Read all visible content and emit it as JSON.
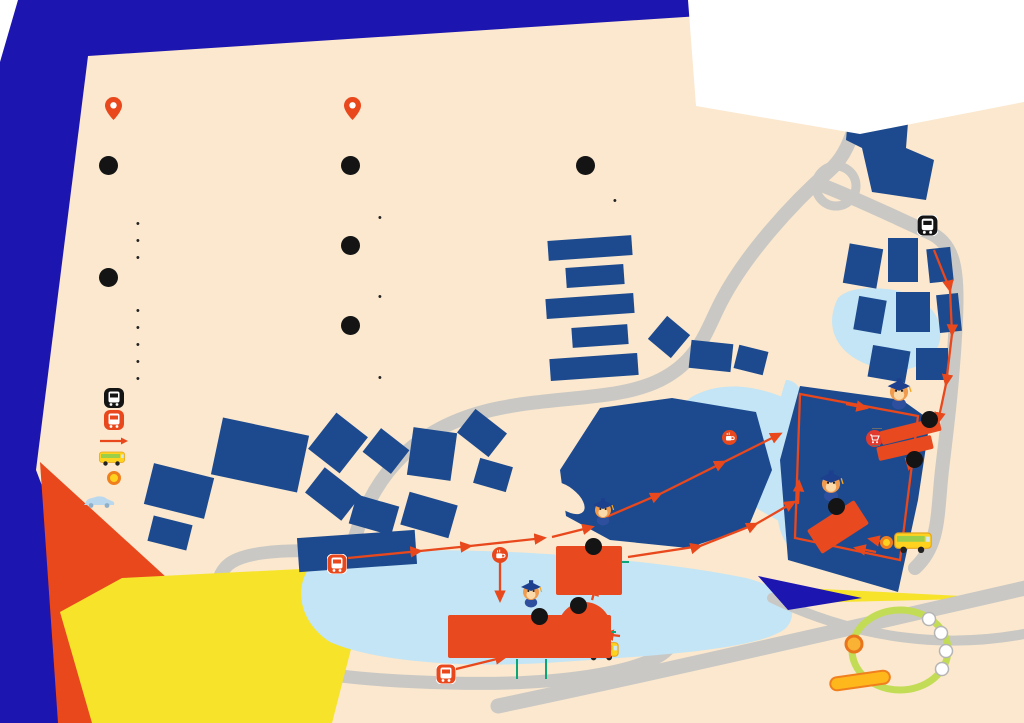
{
  "colors": {
    "bg_blue": "#1c15b0",
    "cream": "#fbe8ce",
    "red": "#e8481c",
    "navy_building": "#1d4a8e",
    "heading_indigo": "#3e3a9c",
    "label_blue": "#2b57a8",
    "teal": "#0aa678",
    "code_orange": "#f5a054",
    "yellow": "#f6e32a",
    "water": "#c3e5f5",
    "road_gray": "#c9c8c4",
    "route_green": "#c3dc55",
    "brand_blue": "#1f3e8e",
    "brand_orange": "#ee7d11"
  },
  "logo": {
    "nus": "NUS",
    "college": "COLLEGE",
    "tagline": "NATIONAL UNIVERSITY OF SINGAPORE",
    "title": "OPEN HOUSE MAP"
  },
  "pins": [
    {
      "name": "Yale-NUS College Campus (NUS College):",
      "address": "16 College Ave West, Singapore 138527"
    },
    {
      "name": "Stephen Riady Centre:",
      "address": "2 College Ave West, Singapore 138607"
    }
  ],
  "venues": [
    {
      "num": "1",
      "heading": [
        {
          "text": "YALE-NUS COLLEGE HALL\n(PERFORMANCE HALL) "
        },
        {
          "text": "(D10)",
          "cls": "c-teal"
        },
        {
          "text": "\n& FOYER "
        },
        {
          "text": "(D11)",
          "cls": "c-teal"
        }
      ],
      "bullets": [
        "NUSC Open House Talks",
        "NUSC Open House Booths",
        "Student Learning Spotlight"
      ]
    },
    {
      "num": "2",
      "heading": [
        {
          "text": "YALE-NUS OCULUS "
        },
        {
          "text": "(D12)",
          "cls": "c-teal"
        },
        {
          "text": "\n(NUS COLLEGE)"
        }
      ],
      "bullets": [
        "NUSC Open House Registration",
        "NUSC College Tours",
        "Games",
        "Lucky Dip",
        "Food Kiosk"
      ]
    },
    {
      "num": "3",
      "heading": [
        {
          "text": "YALE-NUS COLLEGE LIBRARY\nPROGRAMME ROOMS 1 "
        },
        {
          "text": "(D13)",
          "cls": "c-teal"
        },
        {
          "text": "\n& 2 "
        },
        {
          "text": "(D14)",
          "cls": "c-teal"
        }
      ],
      "bullets": [
        "NUSC Sample Classes"
      ]
    },
    {
      "num": "4",
      "heading": [
        {
          "text": "STEPHEN RIADY CENTRE\nLECTURE THEATRE 51 "
        },
        {
          "text": "(A10)",
          "cls": "c-orange"
        },
        {
          "text": "\n(LEVEL 1)"
        }
      ],
      "bullets": [
        "NUSC Open House Talks"
      ]
    },
    {
      "num": "5",
      "heading": [
        {
          "text": "STEPHEN RIADY CENTRE\nSEMINAR ROOM 2 "
        },
        {
          "text": "(A12)",
          "cls": "c-orange"
        },
        {
          "text": "\n(LEVEL 1)"
        }
      ],
      "bullets": [
        "NUSC Sample Classes"
      ]
    },
    {
      "num": "6",
      "heading": [
        {
          "text": "STEPHEN RIADY CENTRE\nATRIUM "
        },
        {
          "text": "(A1)",
          "cls": "c-orange"
        },
        {
          "text": " (LEVEL 1)"
        }
      ],
      "bullets": [
        "NUSC Impact Experience\nProject Showcase\n@ NUS120 Experience"
      ]
    }
  ],
  "legend": {
    "items": [
      {
        "icon": "internal-shuttle-bus-stop",
        "label": "Internal Shuttle Bus Stop"
      },
      {
        "icon": "public-bus-stop",
        "label": "Public Bus Stop"
      },
      {
        "icon": "walk-path",
        "label": "Walk Path"
      },
      {
        "icon": "utown-shuttle-bus",
        "label": "UTown Shuttle Bus"
      },
      {
        "icon": "utown-shuttle-bus-stop",
        "label": "UTown Shuttle Bus Stop"
      }
    ],
    "parking_note": "Kindly note that parking is not allowed\nin NUS UTown on Open House Day (8 March)\nwithout authorised car decals.\nPlease park at the nearest locations and\nmake your way to our campus."
  },
  "callout": [
    {
      "text": "From "
    },
    {
      "text": "3",
      "cls": "badge"
    },
    {
      "text": " "
    },
    {
      "text": "YALE-NUS COLLEGE LIBRARY,",
      "cls": "strong"
    },
    {
      "text": "\nwalk along the corridor to reach\n"
    },
    {
      "text": "",
      "cls": "ic-coffee"
    },
    {
      "text": " "
    },
    {
      "text": "Cafe Agora",
      "cls": "strong"
    },
    {
      "text": " then head down\nthe "
    },
    {
      "text": "",
      "cls": "ic-stairs"
    },
    {
      "text": " staircase through the garden\nto reach "
    },
    {
      "text": "1",
      "cls": "badge"
    },
    {
      "text": " "
    },
    {
      "text": "YALE-NUS COLLEGE HALL\n(PERFORMANCE HALL) & FOYER",
      "cls": "strong"
    },
    {
      "text": " and\n"
    },
    {
      "text": "2",
      "cls": "badge"
    },
    {
      "text": " "
    },
    {
      "text": "YALE-NUS OCULUS (NUS COLLEGE)",
      "cls": "strong"
    }
  ],
  "map": {
    "labels": {
      "create_way": "CREATE WAY",
      "college_ave_east": "COLLEGE AVE EAST",
      "college_ave_west": "COLLEGE AVE WEST",
      "utown_bus_stop": "UTown\nBus Stop\nD1, D2",
      "town_plaza": "TOWN\nPLAZA",
      "town_green": "TOWN\nGREEN",
      "nusc_nus": "NUS",
      "nusc_c": "C",
      "starbucks": "Starbucks",
      "fairprice": "Fairprice\nExpress",
      "stephen_riady_centre": "Stephen\nRiady Centre",
      "university_town_bus_stop": "University Town\nBus Stop\n(Dover Road)\n33, 196",
      "yale_nus_bus_stop": "Yale-NUS Bus Stop\n33, 96, 151, 183, 196",
      "cafe_agora": "Cafe Agora",
      "campus": "YALE-NUS\nCOLLEGE\nCAMPUS",
      "utown_shuttle_oculus": "UTown Shuttle Stop:\nYale-NUS OCULUS\n(NUS College)",
      "utown_shuttle_src": "UTown\nShuttle Stop:\nStephen Riady Centre"
    },
    "markers": {
      "m1": "1",
      "m2": "2",
      "m3": "3",
      "m4": "4",
      "m5": "5",
      "m6": "6"
    },
    "signs": {
      "hall": "YALE-NUS COLLEGE HALL\n(PERFORMANCE HALL)\n& FOYER",
      "oculus": "YALE-NUS\nOCULUS\n(NUSC)",
      "library": "YALE-NUS\nCOLLEGE LIBRARY\nPROGRAMME\nROOMS 1 & 2",
      "src_lt51": "SRC LT 51",
      "src_sr2": "SRC SR 2",
      "src_atrium": "SRC\nATRIUM"
    },
    "codes": {
      "d10": "(D10)",
      "d11": "(D11)",
      "d12": "(D12)",
      "d13_d14": "(D13, D14)",
      "a10": "(A10)",
      "a12": "(A12)",
      "a1": "(A1)"
    },
    "route": {
      "left_stops": [
        "YALE-NUS OCULUS\n(NUS COLLEGE)",
        "STEPHEN RIADY\nCENTRE"
      ],
      "right_stops": [
        "RESIDENTIAL COLLEGE 4",
        "COLLEGE OF ALICE &\nPETER TAN",
        "CHUA THIAN POH HALL",
        "TEMBUSU COLLEGE"
      ]
    }
  }
}
